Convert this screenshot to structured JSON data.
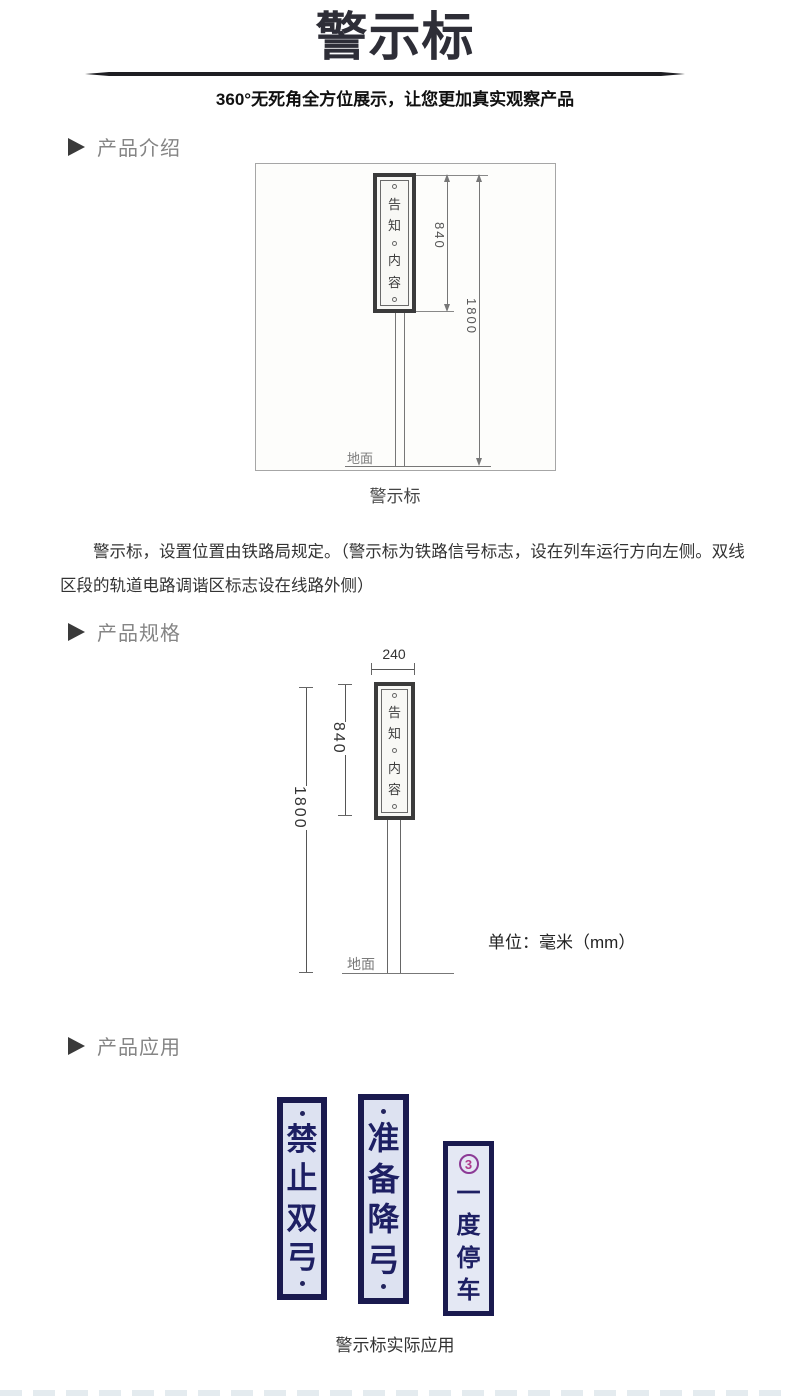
{
  "header": {
    "title": "警示标",
    "subtitle": "360°无死角全方位展示，让您更加真实观察产品"
  },
  "sections": {
    "intro_label": "产品介绍",
    "spec_label": "产品规格",
    "app_label": "产品应用"
  },
  "intro": {
    "diagram": {
      "panel_chars": [
        "告",
        "知",
        "内",
        "容"
      ],
      "dim_sign_height": "840",
      "dim_total_height": "1800",
      "ground_label": "地面"
    },
    "caption": "警示标",
    "paragraph": "警示标，设置位置由铁路局规定。（警示标为铁路信号标志，设在列车运行方向左侧。双线区段的轨道电路调谐区标志设在线路外侧）"
  },
  "spec": {
    "diagram": {
      "dim_width": "240",
      "dim_sign_height": "840",
      "dim_total_height": "1800",
      "panel_chars": [
        "告",
        "知",
        "内",
        "容"
      ],
      "ground_label": "地面"
    },
    "unit_note": "单位：毫米（mm）"
  },
  "application": {
    "signs": [
      {
        "chars": [
          "禁",
          "止",
          "双",
          "弓"
        ]
      },
      {
        "chars": [
          "准",
          "备",
          "降",
          "弓"
        ]
      },
      {
        "chars": [
          "一",
          "度",
          "停",
          "车"
        ],
        "badge": "3"
      }
    ],
    "caption": "警示标实际应用"
  },
  "colors": {
    "title_text": "#2e2e37",
    "section_label": "#858585",
    "sign_frame_navy": "#1a1a4f",
    "sign_text_navy": "#1d1f63",
    "sign_bg": "#dde2f1",
    "badge_magenta": "#8c3a96"
  }
}
